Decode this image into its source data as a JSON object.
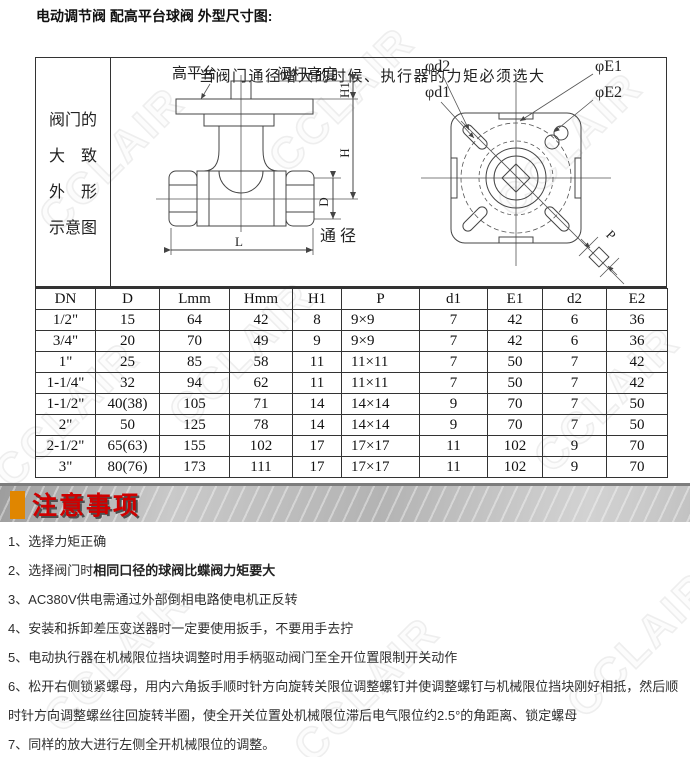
{
  "title": "电动调节阀  配高平台球阀  外型尺寸图:",
  "watermark": "CCLAIR",
  "drawing": {
    "note": "当阀门通径增大的时候、执行器的力矩必须选大",
    "side_label_lines": [
      "阀门的",
      "大　致",
      "外　形",
      "示意图"
    ],
    "labels": {
      "high_platform": "高平台",
      "stem_height": "阀杆高度",
      "bore": "通径",
      "phi_d2": "φd2",
      "phi_d1": "φd1",
      "phi_E1": "φE1",
      "phi_E2": "φE2"
    },
    "dims": {
      "H1": "H1",
      "H": "H",
      "D": "D",
      "L": "L",
      "P": "P"
    }
  },
  "table": {
    "headers": [
      "DN",
      "D",
      "Lmm",
      "Hmm",
      "H1",
      "P",
      "d1",
      "E1",
      "d2",
      "E2"
    ],
    "col_widths": [
      60,
      64,
      70,
      63,
      49,
      78,
      68,
      55,
      64,
      61
    ],
    "rows": [
      [
        "1/2\"",
        "15",
        "64",
        "42",
        "8",
        "9×9",
        "7",
        "42",
        "6",
        "36"
      ],
      [
        "3/4\"",
        "20",
        "70",
        "49",
        "9",
        "9×9",
        "7",
        "42",
        "6",
        "36"
      ],
      [
        "1\"",
        "25",
        "85",
        "58",
        "11",
        "11×11",
        "7",
        "50",
        "7",
        "42"
      ],
      [
        "1-1/4\"",
        "32",
        "94",
        "62",
        "11",
        "11×11",
        "7",
        "50",
        "7",
        "42"
      ],
      [
        "1-1/2\"",
        "40(38)",
        "105",
        "71",
        "14",
        "14×14",
        "9",
        "70",
        "7",
        "50"
      ],
      [
        "2\"",
        "50",
        "125",
        "78",
        "14",
        "14×14",
        "9",
        "70",
        "7",
        "50"
      ],
      [
        "2-1/2\"",
        "65(63)",
        "155",
        "102",
        "17",
        "17×17",
        "11",
        "102",
        "9",
        "70"
      ],
      [
        "3\"",
        "80(76)",
        "173",
        "111",
        "17",
        "17×17",
        "11",
        "102",
        "9",
        "70"
      ]
    ]
  },
  "notice": {
    "header": "注意事项",
    "accent_color": "#e08600",
    "header_color": "#cf0000",
    "items": [
      {
        "num": "1、",
        "text": "选择力矩正确"
      },
      {
        "num": "2、",
        "text": "选择阀门时",
        "bold_text": "相同口径的球阀比蝶阀力矩要大"
      },
      {
        "num": "3、",
        "text": "AC380V供电需通过外部倒相电路使电机正反转"
      },
      {
        "num": "4、",
        "text": "安装和拆卸差压变送器时一定要使用扳手，不要用手去拧"
      },
      {
        "num": "5、",
        "text": "电动执行器在机械限位挡块调整时用手柄驱动阀门至全开位置限制开关动作"
      },
      {
        "num": "6、",
        "text": "松开右侧锁紧螺母，用内六角扳手顺时针方向旋转关限位调整螺钉并使调整螺钉与机械限位挡块刚好相抵，然后顺时针方向调整螺丝往回旋转半圈，使全开关位置处机械限位滞后电气限位约2.5°的角距离、锁定螺母"
      },
      {
        "num": "7、",
        "text": "同样的放大进行左侧全开机械限位的调整。"
      }
    ]
  }
}
